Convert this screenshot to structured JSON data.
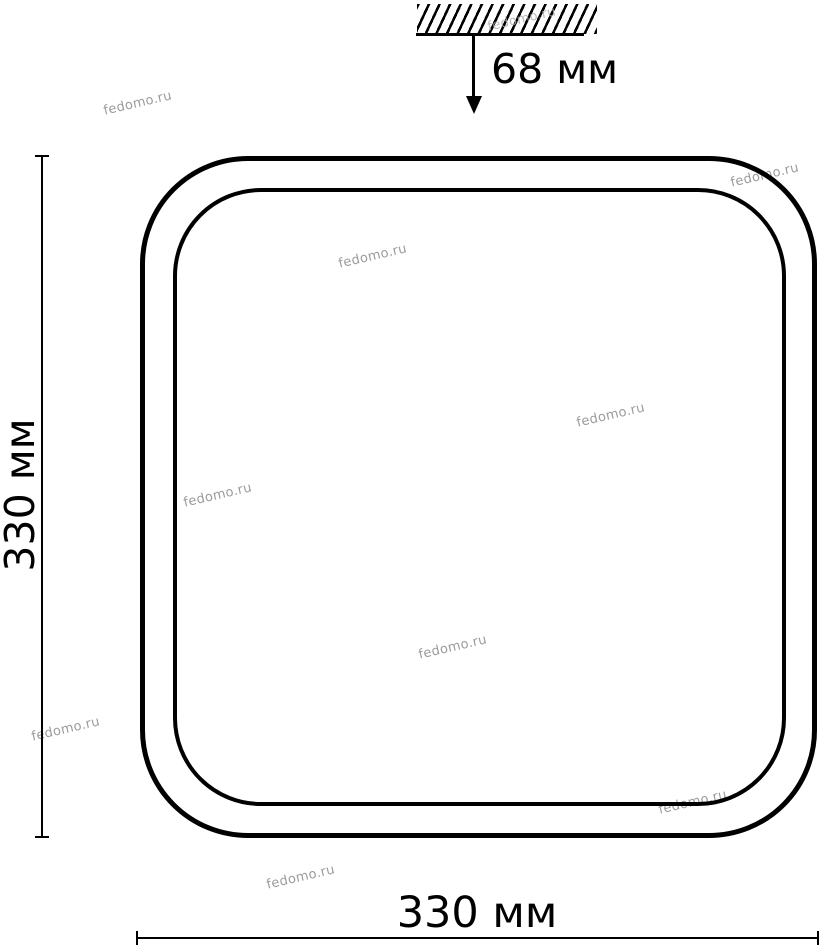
{
  "diagram": {
    "labels": {
      "ceiling_offset": "68 мм",
      "side_height": "330 мм",
      "bottom_width": "330 мм"
    },
    "watermark": "fedomo.ru",
    "colors": {
      "line": "#000000",
      "text": "#000000",
      "watermark": "#9b9b9b"
    }
  }
}
